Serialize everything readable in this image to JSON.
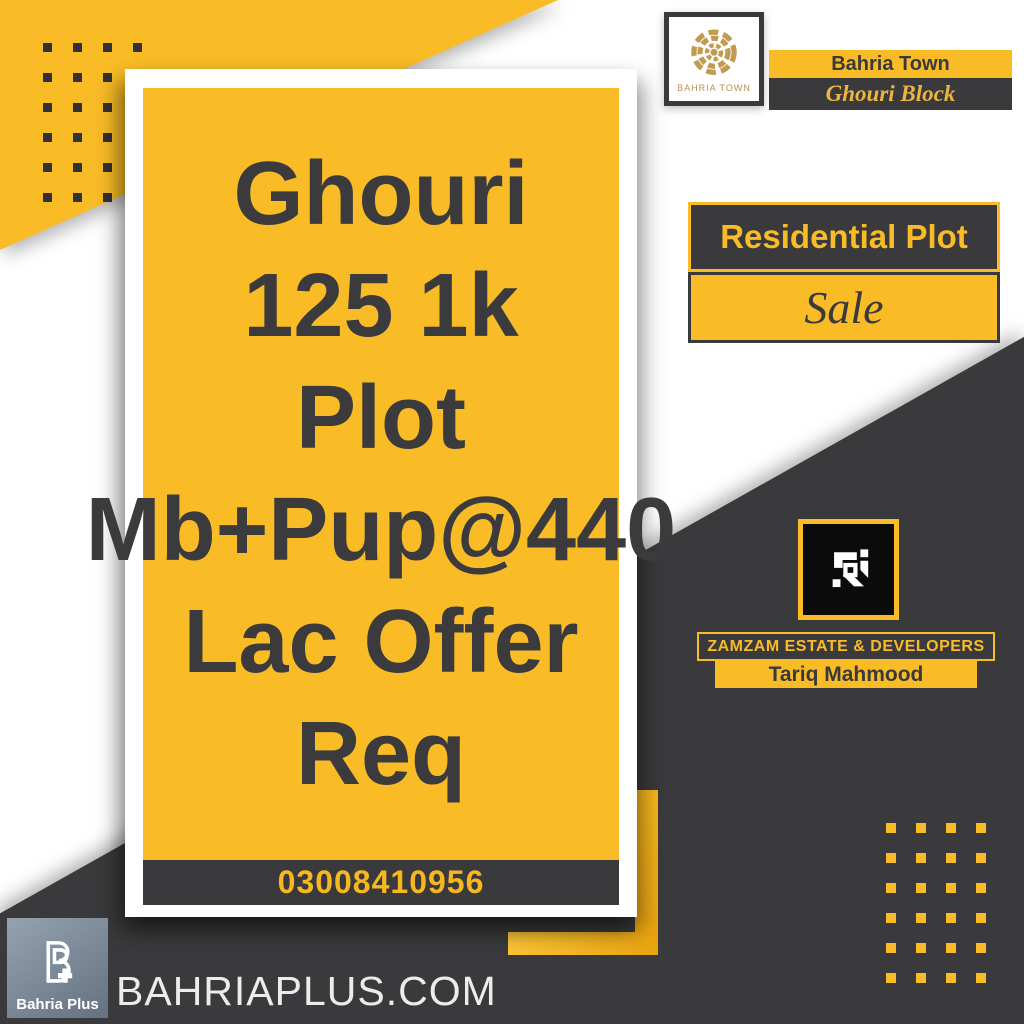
{
  "brand": {
    "emblem_caption": "BAHRIA TOWN",
    "town": "Bahria Town",
    "block": "Ghouri Block"
  },
  "listing": {
    "type": "Residential Plot",
    "status": "Sale"
  },
  "card": {
    "lines": [
      "Ghouri",
      "125 1k",
      "Plot",
      "Mb+Pup@440",
      "Lac Offer",
      "Req"
    ],
    "phone": "03008410956"
  },
  "agency": {
    "name": "ZAMZAM ESTATE & DEVELOPERS",
    "agent": "Tariq Mahmood"
  },
  "footer": {
    "logo_caption": "Bahria Plus",
    "website": "BAHRIAPLUS.COM"
  },
  "colors": {
    "accent_yellow": "#F9BC26",
    "charcoal": "#3A3A3C",
    "gold": "#C29B52",
    "phone_text": "#F7B81F"
  }
}
